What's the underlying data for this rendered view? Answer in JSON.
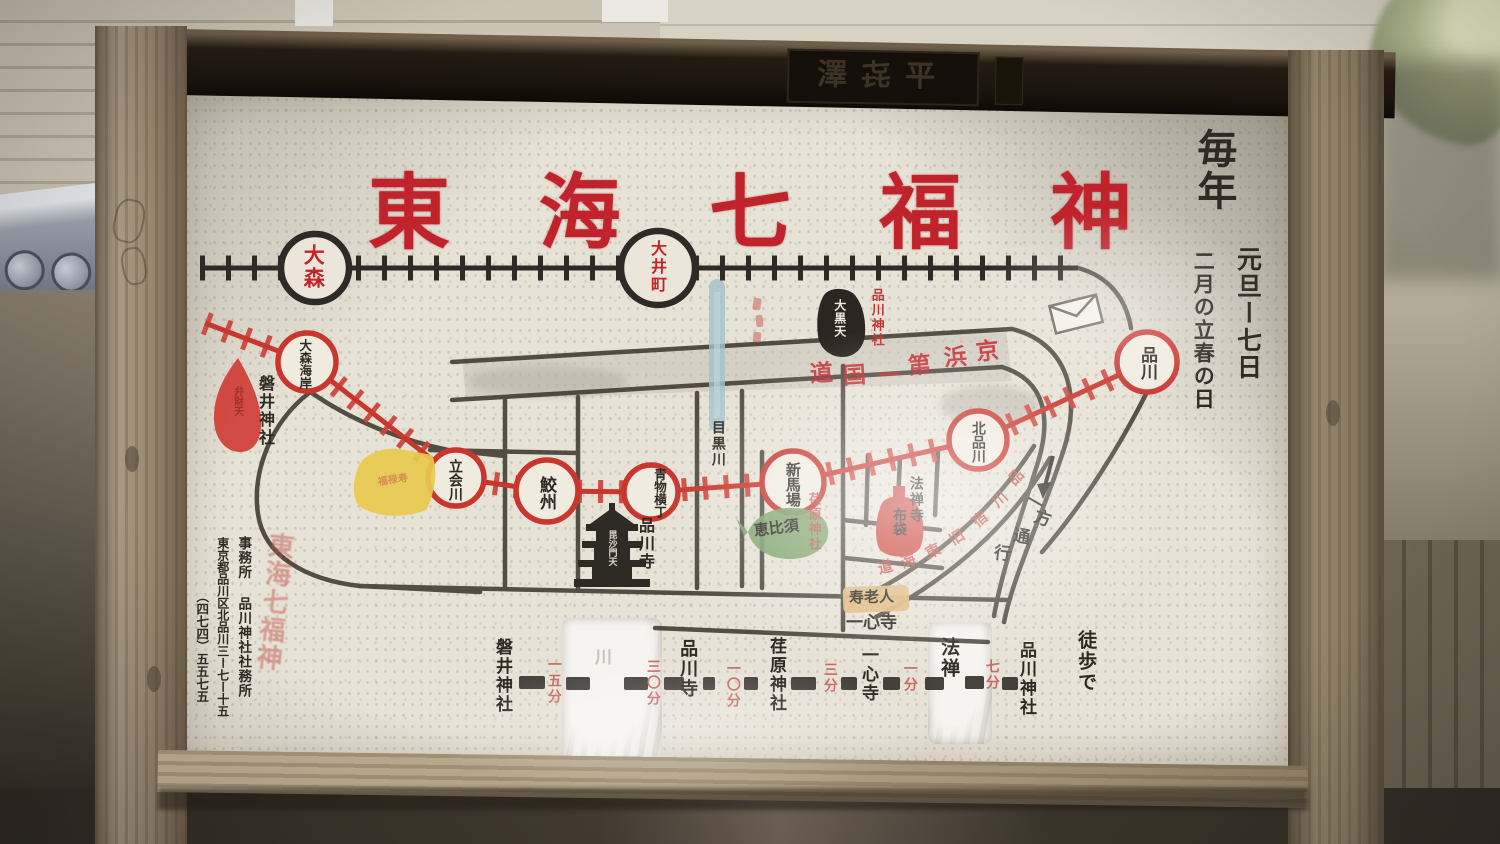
{
  "plaque": {
    "text": "澤㐂平"
  },
  "title": {
    "full": "東海七福神",
    "chars": [
      "東",
      "海",
      "七",
      "福",
      "神"
    ]
  },
  "schedule": {
    "every_year": "毎年",
    "dates": "元旦ー七日",
    "spring": "二月の立春の日"
  },
  "jr_line": {
    "stations": [
      "大森",
      "大井町"
    ]
  },
  "keikyu_line": {
    "stations": [
      "大森海岸",
      "立会川",
      "鮫州",
      "青物横丁",
      "新馬場",
      "北品川",
      "品川"
    ]
  },
  "places": {
    "iwai_jinja": "磐井神社",
    "shinagawa_ji": "品川寺",
    "hozen_ji": "法禅寺",
    "isshin_ji": "一心寺",
    "ebara_jinja": "荏原神社",
    "shinagawa_jinja": "品川神社",
    "meguro_river": "目黒川"
  },
  "deities": {
    "benzaiten": "弁財天",
    "fukurokuju": "福禄寿",
    "bishamonten": "毘沙門天",
    "ebisu": "恵比須",
    "hotei": "布袋",
    "jurojin": "寿老人",
    "daikokuten": "大黒天"
  },
  "roads": {
    "keihin_chars": [
      "道",
      "国",
      "一",
      "第",
      "浜",
      "京"
    ],
    "old_tokaido_chars": [
      "道",
      "海",
      "東",
      "旧",
      "宿",
      "川",
      "品"
    ],
    "one_way_chars": [
      "一",
      "方",
      "通",
      "行"
    ]
  },
  "route_table": {
    "items": [
      {
        "kind": "name",
        "text": "磐井神社"
      },
      {
        "kind": "time",
        "text": "一五分"
      },
      {
        "kind": "name",
        "text": "川",
        "worn": true
      },
      {
        "kind": "time",
        "text": "三〇分"
      },
      {
        "kind": "name",
        "text": "品川寺"
      },
      {
        "kind": "time",
        "text": "一〇分"
      },
      {
        "kind": "name",
        "text": "荏原神社"
      },
      {
        "kind": "time",
        "text": "三分"
      },
      {
        "kind": "name",
        "text": "一心寺"
      },
      {
        "kind": "time",
        "text": "一分"
      },
      {
        "kind": "name",
        "text": "法禅"
      },
      {
        "kind": "time",
        "text": "七分"
      },
      {
        "kind": "name",
        "text": "品川神社"
      }
    ],
    "walk_note": "徒歩で"
  },
  "office": {
    "faded_red": "東海七福神",
    "line1": "事務所 品川神社社務所",
    "line2": "東京都品川区北品川三ー七ー十五",
    "line3": "（四七四）五五七五"
  },
  "colors": {
    "title_red": "#c2242a",
    "line_red": "#c8362e",
    "ink_black": "#2e2a24",
    "river_blue": "#a4c3ca"
  }
}
